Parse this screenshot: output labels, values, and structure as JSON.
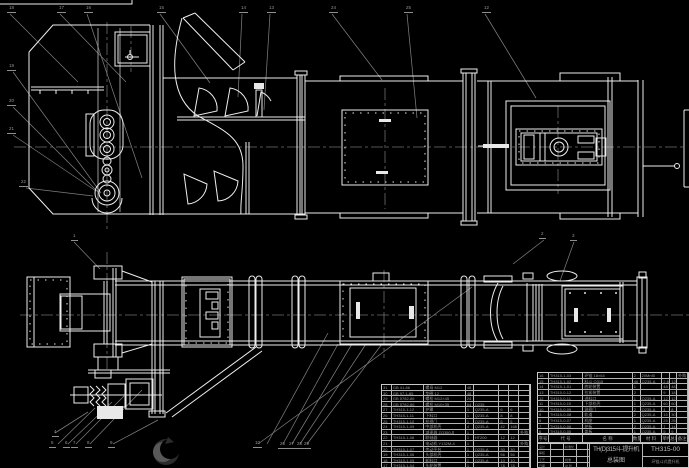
{
  "meta": {
    "background": "#000000",
    "line_color": "#ededed",
    "dim_color": "#7d7d7d",
    "table_text_color": "#9a9a9a"
  },
  "title_block": {
    "product_line1": "TH(D)315斗-提升机",
    "product_line2": "总装图",
    "drawing_number": "TH315-00",
    "subtitle": "环链斗式提升机",
    "sig_rows": [
      [
        "设计",
        "",
        "标准化",
        ""
      ],
      [
        "审核",
        "",
        "",
        ""
      ],
      [
        "工艺",
        "",
        "批准",
        ""
      ],
      [
        "日期",
        "",
        "共 张",
        ""
      ]
    ]
  },
  "bom": {
    "header": [
      "序号",
      "代 号",
      "名 称",
      "数量",
      "材 料",
      "单件",
      "总计",
      "备注"
    ],
    "left_rows": [
      [
        "31",
        "GB 41-86",
        "螺母 M12",
        "48",
        "",
        "",
        "",
        ""
      ],
      [
        "30",
        "GB 97.1-85",
        "垫圈 12",
        "48",
        "",
        "",
        "",
        ""
      ],
      [
        "29",
        "GB 5782-86",
        "螺栓 M12×45",
        "24",
        "",
        "",
        "",
        ""
      ],
      [
        "28",
        "GB 5782-86",
        "螺栓 M10×35",
        "64",
        "Q235",
        "",
        "",
        ""
      ],
      [
        "27",
        "TH315-1-12",
        "护罩",
        "1",
        "Q235-A",
        "6",
        "6",
        ""
      ],
      [
        "26",
        "TH315-1-11",
        "下料口",
        "1",
        "Q235-A",
        "8",
        "8",
        ""
      ],
      [
        "25",
        "TH315-1-10",
        "检视门",
        "1",
        "Q235-A",
        "5",
        "5",
        ""
      ],
      [
        "24",
        "TH315-1-09",
        "中部机壳",
        "4",
        "Q235-A",
        "42",
        "168",
        ""
      ],
      [
        "23",
        "",
        "减速器 ZQ350-Ⅱ",
        "1",
        "",
        "",
        "",
        "外购"
      ],
      [
        "22",
        "TH315-1-08",
        "联轴器",
        "1",
        "HT200",
        "12",
        "12",
        ""
      ],
      [
        "21",
        "",
        "电动机 Y132M-4",
        "1",
        "",
        "",
        "",
        "外购"
      ],
      [
        "20",
        "TH315-1-07",
        "传动平台",
        "1",
        "Q235-A",
        "30",
        "30",
        ""
      ],
      [
        "19",
        "TH315-1-06",
        "头部机壳",
        "1",
        "Q235-A",
        "56",
        "56",
        ""
      ],
      [
        "18",
        "TH315-1-05",
        "卸料口",
        "1",
        "Q235-A",
        "10",
        "10",
        ""
      ],
      [
        "17",
        "TH315-1-04",
        "头轮装置",
        "1",
        "",
        "78",
        "78",
        ""
      ]
    ],
    "right_rows": [
      [
        "16",
        "TH315-1-03",
        "环链 18×64",
        "2",
        "20MnSi",
        "",
        "",
        "外购"
      ],
      [
        "15",
        "TH315-1-02",
        "料斗 Q315",
        "46",
        "Q235-A",
        "2.6",
        "120",
        ""
      ],
      [
        "14",
        "TH315-1-01",
        "底轮装置",
        "1",
        "",
        "48",
        "48",
        ""
      ],
      [
        "13",
        "TH315-0-12",
        "拉紧装置",
        "2",
        "",
        "9",
        "18",
        ""
      ],
      [
        "12",
        "TH315-0-11",
        "进料口",
        "1",
        "Q235-A",
        "12",
        "12",
        ""
      ],
      [
        "11",
        "TH315-0-10",
        "下部机壳",
        "1",
        "Q235-A",
        "60",
        "60",
        ""
      ],
      [
        "10",
        "TH315-0-09",
        "观察门",
        "2",
        "Q235-A",
        "4",
        "8",
        ""
      ],
      [
        "9",
        "TH315-0-08",
        "轨道",
        "2",
        "Q235-A",
        "15",
        "30",
        ""
      ],
      [
        "8",
        "TH315-0-07",
        "机座",
        "1",
        "Q235-A",
        "25",
        "25",
        ""
      ],
      [
        "7",
        "TH315-0-06",
        "护板",
        "2",
        "Q235-A",
        "7",
        "14",
        ""
      ],
      [
        "6",
        "TH315-0-05",
        "盖板",
        "1",
        "Q235-A",
        "9",
        "9",
        ""
      ]
    ]
  },
  "callouts": [
    {
      "x": 10,
      "y": 6,
      "t": "18"
    },
    {
      "x": 60,
      "y": 6,
      "t": "17"
    },
    {
      "x": 87,
      "y": 6,
      "t": "16"
    },
    {
      "x": 160,
      "y": 6,
      "t": "15"
    },
    {
      "x": 242,
      "y": 6,
      "t": "14"
    },
    {
      "x": 270,
      "y": 6,
      "t": "13"
    },
    {
      "x": 332,
      "y": 6,
      "t": "24"
    },
    {
      "x": 407,
      "y": 6,
      "t": "25"
    },
    {
      "x": 485,
      "y": 6,
      "t": "12"
    },
    {
      "x": 10,
      "y": 64,
      "t": "19"
    },
    {
      "x": 10,
      "y": 99,
      "t": "20"
    },
    {
      "x": 10,
      "y": 127,
      "t": "21"
    },
    {
      "x": 22,
      "y": 180,
      "t": "22"
    },
    {
      "x": 74,
      "y": 234,
      "t": "1"
    },
    {
      "x": 542,
      "y": 232,
      "t": "2"
    },
    {
      "x": 573,
      "y": 234,
      "t": "3"
    },
    {
      "x": 55,
      "y": 430,
      "t": "4"
    },
    {
      "x": 52,
      "y": 441,
      "t": "5"
    },
    {
      "x": 66,
      "y": 441,
      "t": "6"
    },
    {
      "x": 74,
      "y": 441,
      "t": "7"
    },
    {
      "x": 88,
      "y": 441,
      "t": "8"
    },
    {
      "x": 111,
      "y": 441,
      "t": "9"
    },
    {
      "x": 256,
      "y": 441,
      "t": "10"
    },
    {
      "x": 281,
      "y": 442,
      "t": "26"
    },
    {
      "x": 290,
      "y": 442,
      "t": "27"
    },
    {
      "x": 298,
      "y": 442,
      "t": "28"
    },
    {
      "x": 305,
      "y": 442,
      "t": "29"
    }
  ]
}
